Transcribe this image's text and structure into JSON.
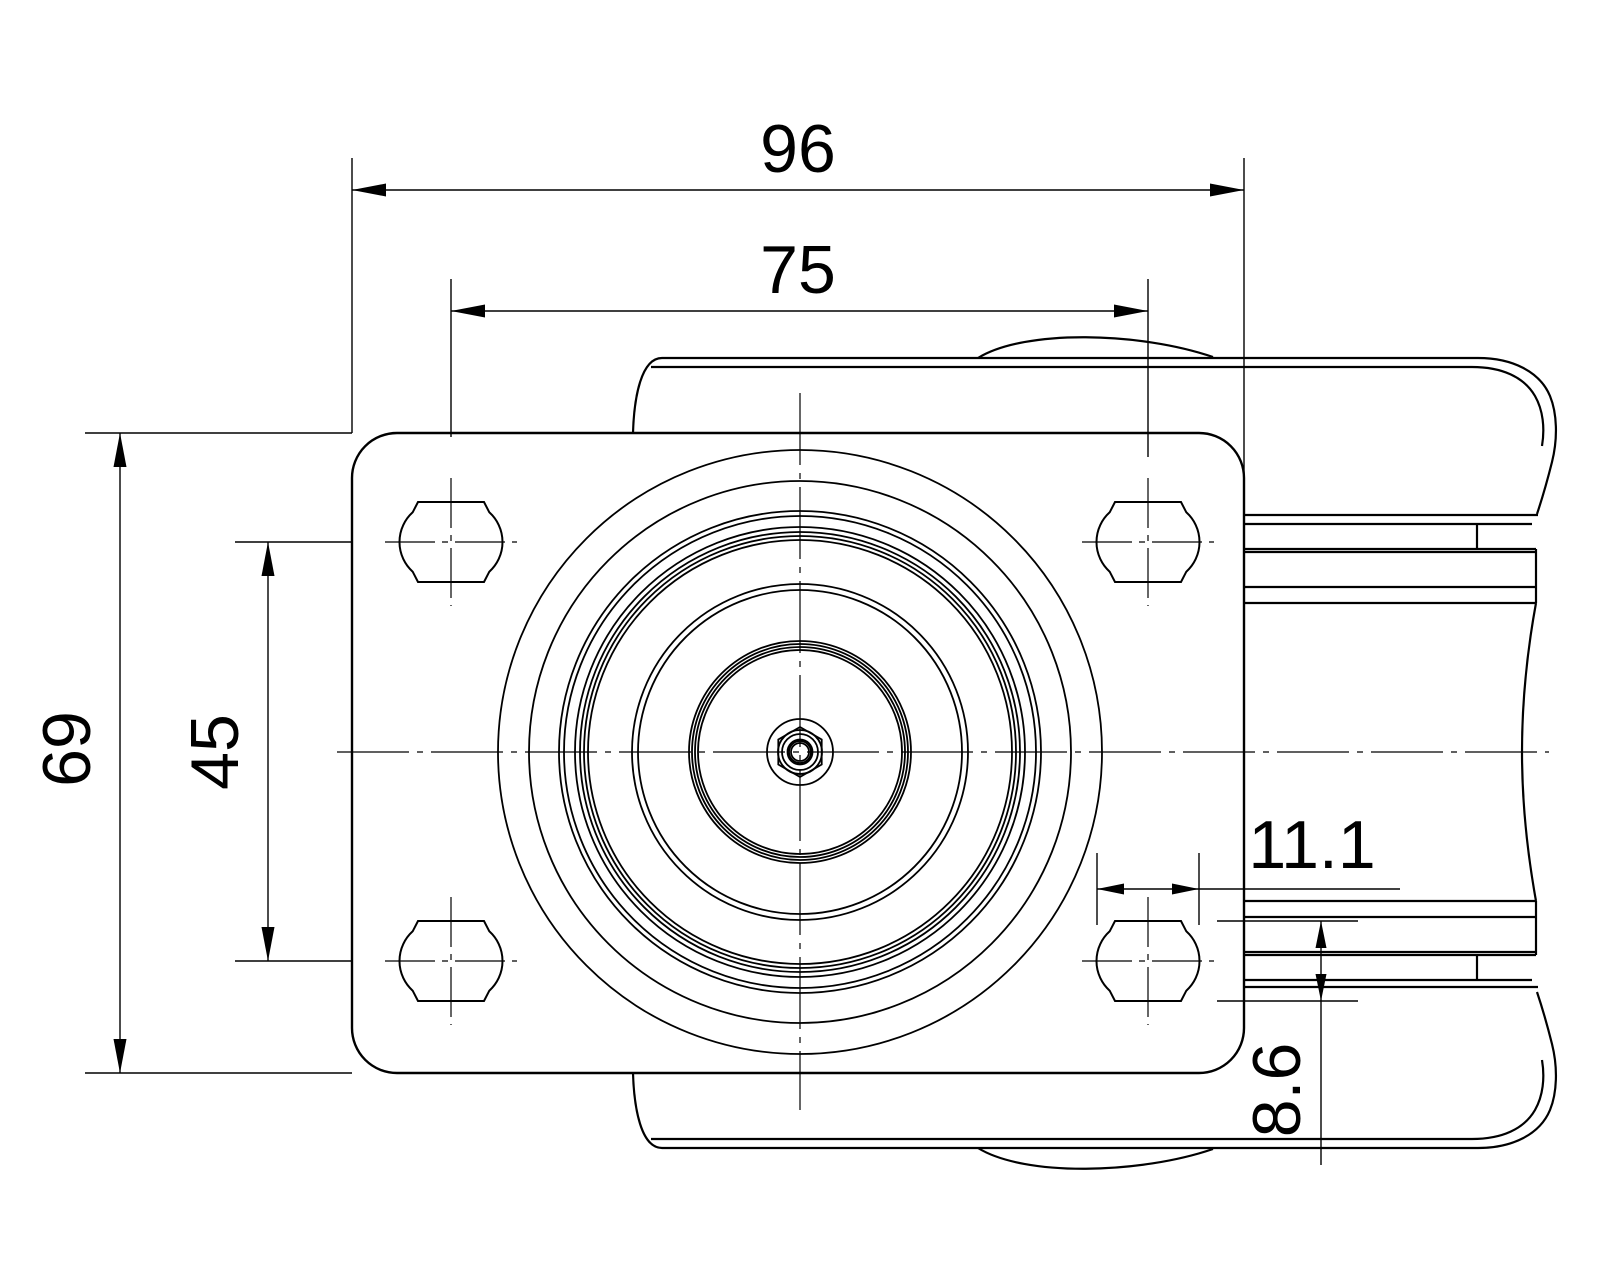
{
  "drawing": {
    "kind": "engineering-drawing-caster-top-view",
    "background_color": "#ffffff",
    "line_color": "#000000",
    "dimensions": {
      "overall_width": "96",
      "bolt_spacing_horizontal": "75",
      "plate_height": "69",
      "bolt_spacing_vertical": "45",
      "slot_hole_width": "11.1",
      "slot_hole_height": "8.6"
    }
  }
}
